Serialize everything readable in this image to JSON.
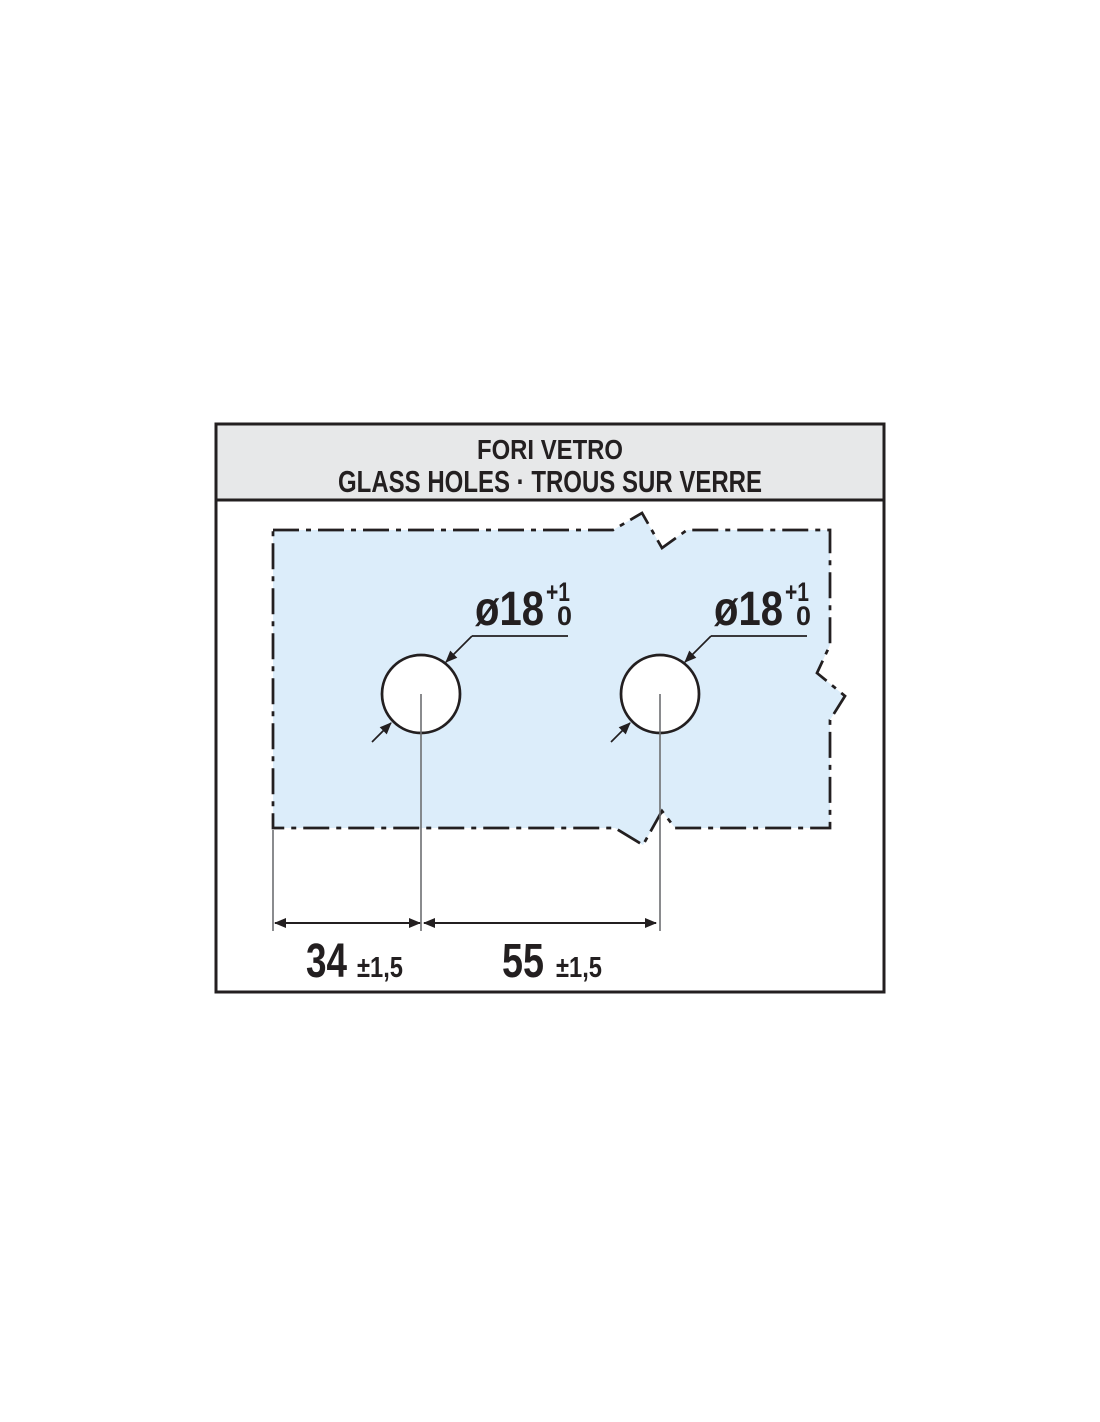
{
  "header": {
    "title": "FORI VETRO",
    "subtitle": "GLASS HOLES · TROUS SUR VERRE"
  },
  "colors": {
    "page_bg": "#ffffff",
    "frame_line": "#231f20",
    "header_bg": "#e7e8e9",
    "title_text": "#231f20",
    "subtitle_text": "#77787b",
    "glass_fill": "#dcedfa",
    "hole_fill": "#ffffff",
    "thin_line": "#6d6e71"
  },
  "glass": {
    "hole_count": 2,
    "hole_label": "ø18",
    "hole_tolerance_upper": "+1",
    "hole_tolerance_lower": "0"
  },
  "dimensions": {
    "edge_to_first_hole": {
      "value": "34",
      "tolerance": "±1,5",
      "unit": "mm"
    },
    "hole_to_hole": {
      "value": "55",
      "tolerance": "±1,5",
      "unit": "mm"
    }
  }
}
